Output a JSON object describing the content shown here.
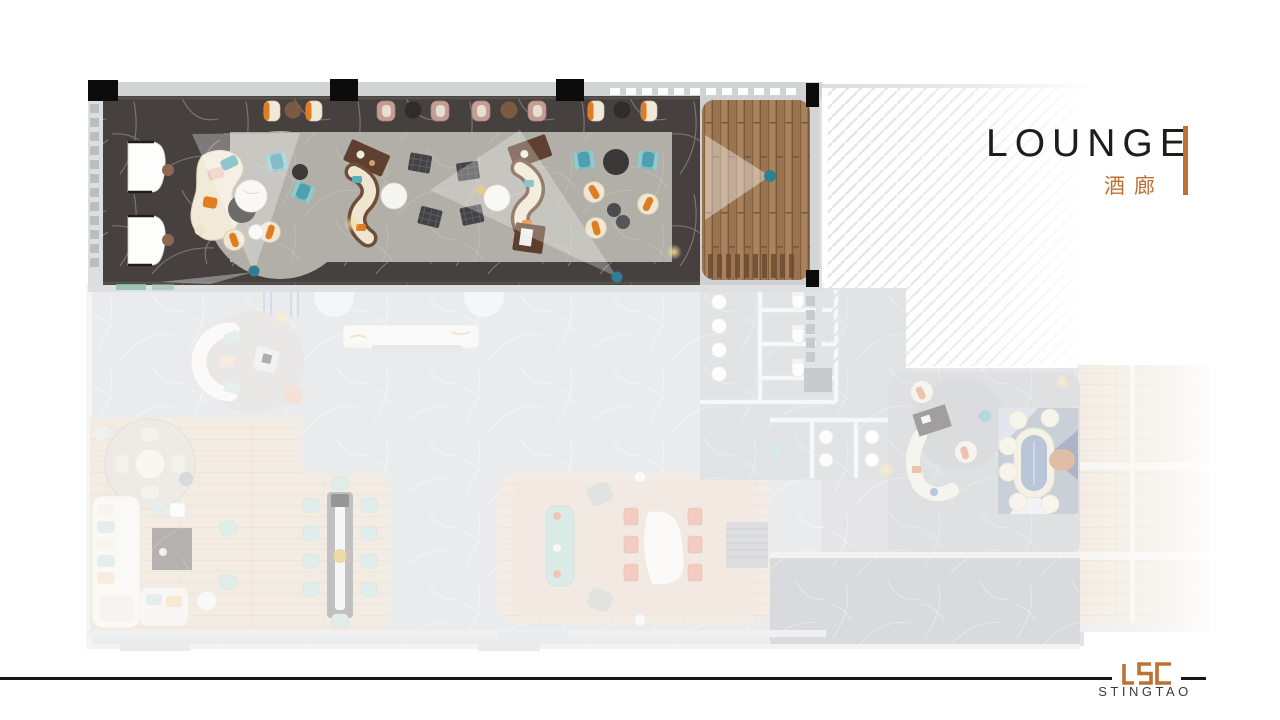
{
  "slide": {
    "title": "LOUNGE",
    "title_zh": "酒廊",
    "logo_mark": "LSC",
    "logo_name": "STINGTAO"
  },
  "colors": {
    "accent": "#bd7233",
    "ink": "#1d1d1c",
    "logo_text": "#3a3a3a",
    "marble_dark": "#46413f",
    "carpet": "#b2afa8",
    "deck_wood": "#9c7450",
    "teal": "#5fadb6",
    "cushion_orange": "#e07c22",
    "cream": "#f1e9d7",
    "plan_gray": "#d6d7da",
    "washed_wood": "#e9ddcc",
    "hatch_line": "#e3e3e6",
    "camera_dot": "#2e7f96"
  }
}
